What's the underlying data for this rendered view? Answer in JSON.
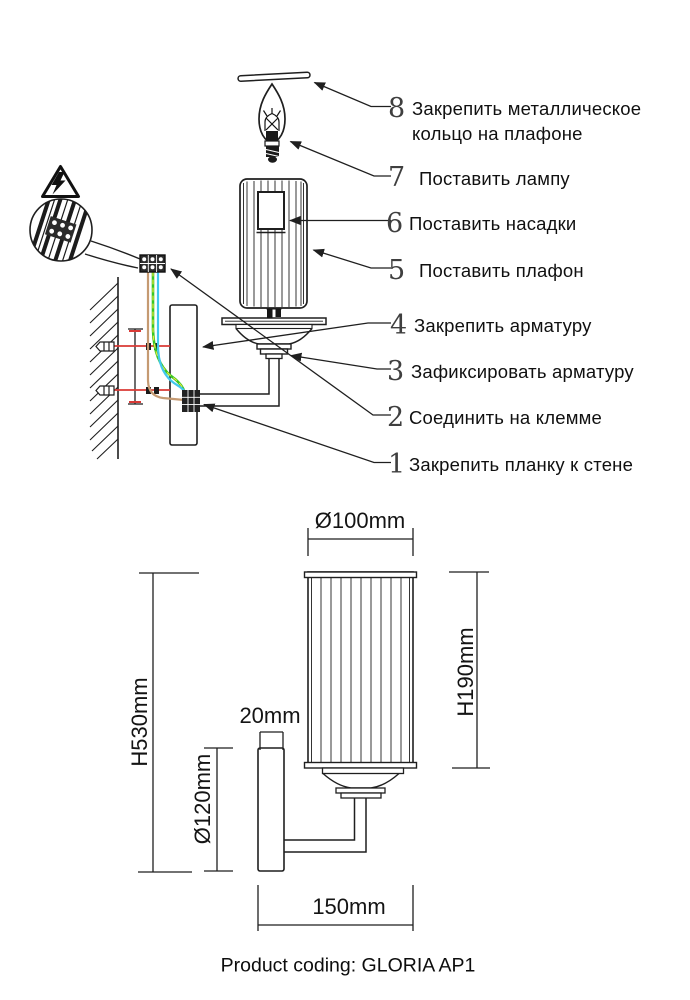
{
  "assembly_steps": [
    {
      "number": "8",
      "lines": [
        "Закрепить металлическое",
        "кольцо на плафоне"
      ]
    },
    {
      "number": "7",
      "lines": [
        "Поставить лампу"
      ]
    },
    {
      "number": "6",
      "lines": [
        "Поставить насадки"
      ]
    },
    {
      "number": "5",
      "lines": [
        "Поставить плафон"
      ]
    },
    {
      "number": "4",
      "lines": [
        "Закрепить арматуру"
      ]
    },
    {
      "number": "3",
      "lines": [
        "Зафиксировать арматуру"
      ]
    },
    {
      "number": "2",
      "lines": [
        "Соединить на клемме"
      ]
    },
    {
      "number": "1",
      "lines": [
        "Закрепить планку к стене"
      ]
    }
  ],
  "dimensions": {
    "shade_diameter": "Ø100mm",
    "shade_height": "H190mm",
    "total_height": "H530mm",
    "backplate_height": "Ø120mm",
    "backplate_depth": "20mm",
    "wall_projection": "150mm"
  },
  "footer": {
    "product_coding": "Product coding: GLORIA AP1"
  },
  "icons": {
    "warning": "electric-shock-warning-triangle",
    "magnifier": "terminal-wiring-detail"
  },
  "colors": {
    "line": "#1f1f1f",
    "wire_brown": "#c59a72",
    "wire_blue": "#41c8ee",
    "wire_green": "#37c626",
    "wire_yellow": "#ede73a",
    "screw_red": "#d93a36"
  }
}
